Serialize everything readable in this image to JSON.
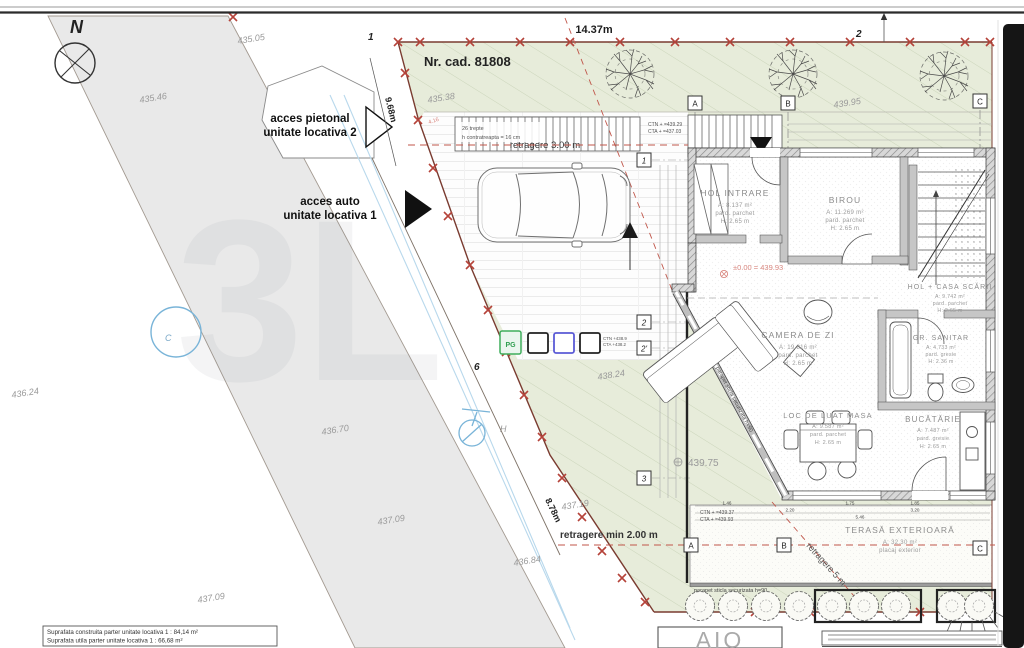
{
  "watermark": "3L",
  "north_label": "N",
  "cadastral": {
    "nr": "Nr. cad. 81808"
  },
  "access": {
    "pietonal_1": "acces pietonal",
    "pietonal_2": "unitate locativa 2",
    "auto_1": "acces auto",
    "auto_2": "unitate locativa 1"
  },
  "dims": {
    "top": "14.37m",
    "left": "9.68m",
    "diag": "8.78m",
    "retragere3": "retragere 3.00 m",
    "retragere2": "retragere min 2.00 m",
    "retragere5": "retragere 5 m",
    "red416": "4.16"
  },
  "elevations": [
    "435.05",
    "435.46",
    "435.38",
    "439.95",
    "436.24",
    "436.70",
    "437.09",
    "437.09",
    "437.19",
    "436.84",
    "438.24",
    "439.75"
  ],
  "levels": {
    "zero": "±0.00 = 439.93"
  },
  "ctn": {
    "north_1": "CTN + =439.29",
    "north_2": "CTA + =437.03",
    "mid_1": "CTN +438.9",
    "mid_2": "CTA +438.2",
    "south_1": "CTN + =439.37",
    "south_2": "CTA + =439.93"
  },
  "notes": {
    "stairs_1": "26 trepte",
    "stairs_2": "h contratreapta = 16 cm",
    "parapet": "parapet sticla securizata h=90"
  },
  "rooms": [
    {
      "name": "HOL INTRARE",
      "area": "A: 8.137 m²",
      "floor": "pard. parchet",
      "height": "H: 2.65 m"
    },
    {
      "name": "BIROU",
      "area": "A: 11.269 m²",
      "floor": "pard. parchet",
      "height": "H: 2.65 m"
    },
    {
      "name": "HOL + CASA SCĂRII",
      "area": "A: 9.742 m²",
      "floor": "pard. parchet",
      "height": "H: 2.65 m"
    },
    {
      "name": "CAMERA DE ZI",
      "area": "A: 19.816 m²",
      "floor": "pard. parchet",
      "height": "H: 2.65 m"
    },
    {
      "name": "GR. SANITAR",
      "area": "A: 4.733 m²",
      "floor": "pard. gresie",
      "height": "H: 2.36 m"
    },
    {
      "name": "LOC DE LUAT MASA",
      "area": "A: 9.587 m²",
      "floor": "pard. parchet",
      "height": "H: 2.65 m"
    },
    {
      "name": "BUCĂTĂRIE",
      "area": "A: 7.487 m²",
      "floor": "pard. gresie",
      "height": "H: 2.65 m"
    },
    {
      "name": "TERASĂ EXTERIOARĂ",
      "area": "A: 32.30 m²",
      "floor": "placaj exterior",
      "height": ""
    }
  ],
  "markers": {
    "grid_cols": [
      "A",
      "B",
      "C"
    ],
    "grid_rows": [
      "1",
      "2",
      "2'",
      "3"
    ],
    "points": {
      "p1": "1",
      "p2": "2",
      "p6": "6"
    },
    "pg": "PG",
    "hydrant": "H",
    "chamber": "C"
  },
  "dim_numbers": {
    "a": "1.46",
    "b": "1.75",
    "c": "1.85",
    "d": "2.20",
    "e": "3.20",
    "f": "5.46"
  },
  "summary": {
    "line1": "Suprafata construita parter unitate locativa 1 : 84,14 m²",
    "line2": "Suprafata utila parter unitate locativa 1 : 66,68 m²"
  },
  "title_block": {
    "logo": "AIO"
  }
}
